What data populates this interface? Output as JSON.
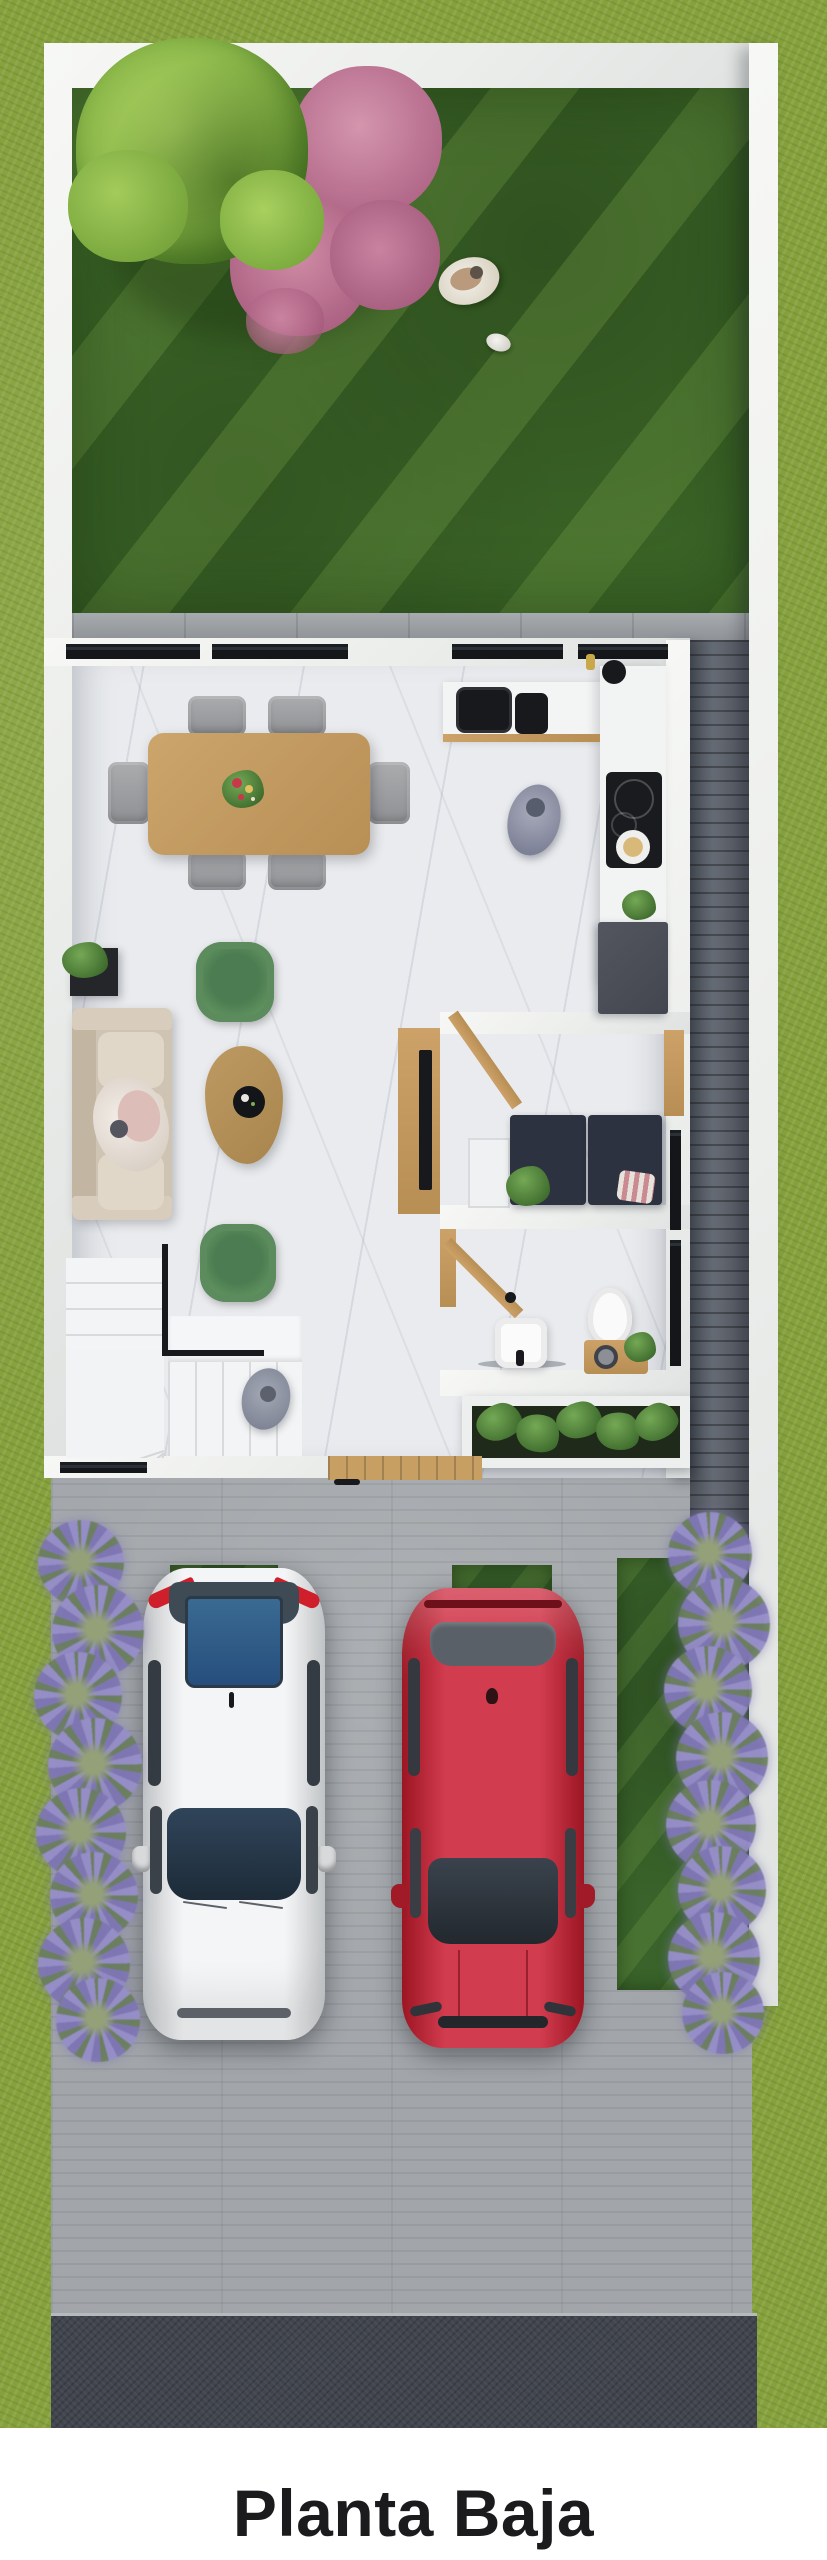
{
  "title": "Planta Baja",
  "scene": {
    "view": "top-down 3D architectural render of a ground-floor plan with backyard, open living-dining-kitchen, study nook, bathroom, stairs, entry and two-car driveway",
    "areas": [
      "backyard-lawn",
      "patio-strip",
      "living-room",
      "dining-room",
      "kitchen",
      "study-nook",
      "bathroom",
      "staircase",
      "entry",
      "side-path",
      "driveway",
      "street"
    ],
    "objects": {
      "trees": [
        "green-round-tree",
        "pink-flowering-tree"
      ],
      "people": [
        "person-on-lawn",
        "person-in-kitchen",
        "person-on-sofa",
        "person-on-stairs"
      ],
      "pet": "small-white-dog",
      "dining_chairs": 6,
      "green_armchairs": 2,
      "lavender_bushes": 16,
      "parking_grass_strips": 3,
      "cars": [
        {
          "position": "left",
          "body_color": "#ecedef",
          "glass_color": "#2d5e92"
        },
        {
          "position": "right",
          "body_color": "#c22433",
          "glass_color": "#555c63"
        }
      ]
    },
    "palette": {
      "outer_grass": "#85a13c",
      "backyard_lawn": "#3a6326",
      "boundary_wall": "#f1f2f0",
      "marble_floor": "#e9ebee",
      "patio_concrete": "#9b9fa3",
      "side_path_planks": "#5c626c",
      "driveway_concrete": "#a2a6aa",
      "street_asphalt": "#41454d",
      "wood_furniture": "#c79f63",
      "dining_table": "#c09a63",
      "gray_chairs": "#96989c",
      "green_chairs": "#61905f",
      "sofa_cream": "#d9cec0",
      "appliance_black": "#17191d",
      "cabinet_gray": "#4b4e57",
      "tree_green": "#8cba4e",
      "tree_pink": "#c47f9a",
      "lavender": "#8f88be",
      "title_text": "#1b1b1d"
    }
  }
}
